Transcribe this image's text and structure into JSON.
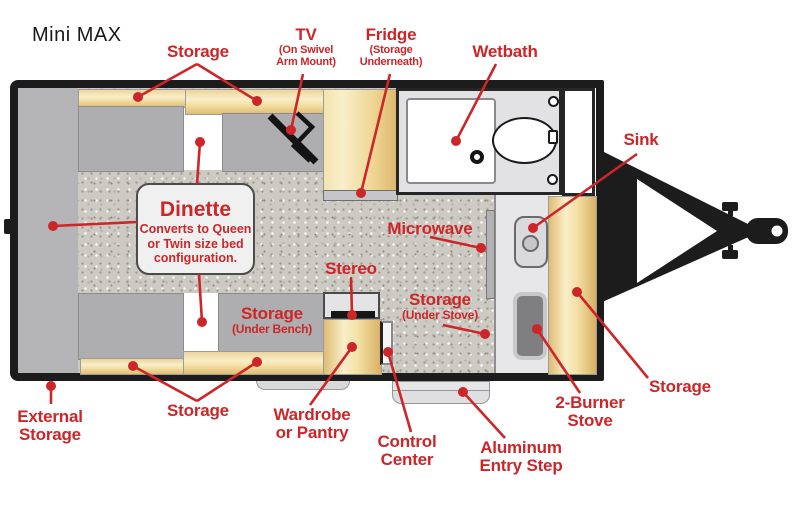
{
  "title": "Mini MAX",
  "colors": {
    "label_red": "#cc2629",
    "cabinet_tan": "#f3e0a4",
    "bench_gray": "#aeaeb0",
    "floor_speckle": "#cdcac3",
    "wall_black": "#1c1c1c"
  },
  "dinette": {
    "title": "Dinette",
    "line1": "Converts to Queen",
    "line2": "or Twin size bed",
    "line3": "configuration."
  },
  "labels": {
    "storage_top": "Storage",
    "tv": "TV",
    "tv_sub1": "(On Swivel",
    "tv_sub2": "Arm Mount)",
    "fridge": "Fridge",
    "fridge_sub1": "(Storage",
    "fridge_sub2": "Underneath)",
    "wetbath": "Wetbath",
    "sink": "Sink",
    "microwave": "Microwave",
    "stereo": "Stereo",
    "storage_under_stove": "Storage",
    "storage_under_stove_sub": "(Under Stove)",
    "storage_under_bench": "Storage",
    "storage_under_bench_sub": "(Under Bench)",
    "external1": "External",
    "external2": "Storage",
    "storage_bottom": "Storage",
    "wardrobe1": "Wardrobe",
    "wardrobe2": "or Pantry",
    "control1": "Control",
    "control2": "Center",
    "step1": "Aluminum",
    "step2": "Entry Step",
    "burner1": "2-Burner",
    "burner2": "Stove",
    "storage_right": "Storage"
  }
}
